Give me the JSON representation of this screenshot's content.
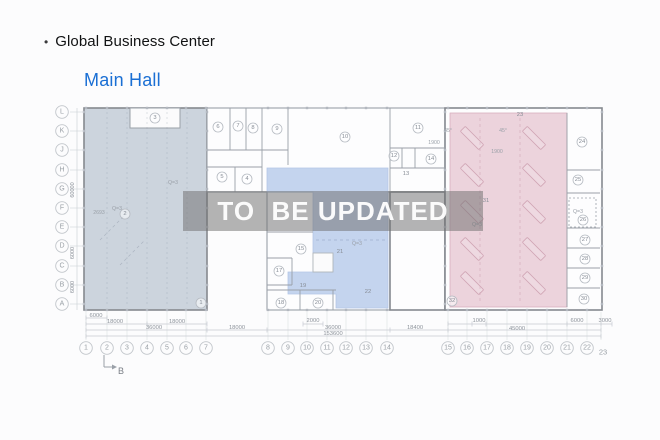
{
  "header": {
    "bullet": "•",
    "title": "Global Business Center",
    "subtitle": "Main Hall"
  },
  "watermark": {
    "text": "TO  BE UPDATED"
  },
  "colors": {
    "page_bg": "#fcfcfd",
    "left_zone": "#ccd4dd",
    "middle_zone": "#c4d4ee",
    "right_zone": "#ecd3dc",
    "subtitle_link": "#1a6fd4",
    "title_text": "#111213",
    "watermark_bg": "rgba(112,112,112,0.52)",
    "watermark_text": "rgba(255,255,255,0.95)",
    "wall": "#9aa0a8",
    "wall_dark": "#85898f",
    "line_light": "#c9cdd3",
    "label": "#8d939b",
    "beam": "#d0a4b4"
  },
  "axes": {
    "rows": [
      {
        "label": "L",
        "y": 112
      },
      {
        "label": "K",
        "y": 131
      },
      {
        "label": "J",
        "y": 150
      },
      {
        "label": "H",
        "y": 170
      },
      {
        "label": "G",
        "y": 189
      },
      {
        "label": "F",
        "y": 208
      },
      {
        "label": "E",
        "y": 227
      },
      {
        "label": "D",
        "y": 246
      },
      {
        "label": "C",
        "y": 266
      },
      {
        "label": "B",
        "y": 285
      },
      {
        "label": "A",
        "y": 304
      }
    ],
    "cols": [
      {
        "label": "1",
        "x": 86
      },
      {
        "label": "2",
        "x": 107
      },
      {
        "label": "3",
        "x": 127
      },
      {
        "label": "4",
        "x": 147
      },
      {
        "label": "5",
        "x": 167
      },
      {
        "label": "6",
        "x": 186
      },
      {
        "label": "7",
        "x": 206
      },
      {
        "label": "8",
        "x": 268
      },
      {
        "label": "9",
        "x": 288
      },
      {
        "label": "10",
        "x": 307
      },
      {
        "label": "11",
        "x": 327
      },
      {
        "label": "12",
        "x": 346
      },
      {
        "label": "13",
        "x": 366
      },
      {
        "label": "14",
        "x": 387
      },
      {
        "label": "15",
        "x": 448
      },
      {
        "label": "16",
        "x": 467
      },
      {
        "label": "17",
        "x": 487
      },
      {
        "label": "18",
        "x": 507
      },
      {
        "label": "19",
        "x": 527
      },
      {
        "label": "20",
        "x": 547
      },
      {
        "label": "21",
        "x": 567
      },
      {
        "label": "22",
        "x": 587
      },
      {
        "label": "23",
        "x": 601,
        "plain": true
      }
    ]
  },
  "rooms": [
    {
      "n": "1",
      "x": 201,
      "y": 303,
      "circled": true
    },
    {
      "n": "2",
      "x": 125,
      "y": 214,
      "circled": true
    },
    {
      "n": "3",
      "x": 155,
      "y": 118,
      "circled": true
    },
    {
      "n": "4",
      "x": 247,
      "y": 179,
      "circled": true
    },
    {
      "n": "5",
      "x": 222,
      "y": 177,
      "circled": true
    },
    {
      "n": "6",
      "x": 218,
      "y": 127,
      "circled": true
    },
    {
      "n": "7",
      "x": 238,
      "y": 126,
      "circled": true
    },
    {
      "n": "8",
      "x": 253,
      "y": 128,
      "circled": true
    },
    {
      "n": "9",
      "x": 277,
      "y": 129,
      "circled": true
    },
    {
      "n": "10",
      "x": 345,
      "y": 137,
      "circled": true
    },
    {
      "n": "11",
      "x": 418,
      "y": 128,
      "circled": true
    },
    {
      "n": "12",
      "x": 394,
      "y": 156,
      "circled": true
    },
    {
      "n": "13",
      "x": 406,
      "y": 174,
      "circled": false
    },
    {
      "n": "14",
      "x": 431,
      "y": 159,
      "circled": true
    },
    {
      "n": "15",
      "x": 301,
      "y": 249,
      "circled": true
    },
    {
      "n": "17",
      "x": 279,
      "y": 271,
      "circled": true
    },
    {
      "n": "18",
      "x": 281,
      "y": 303,
      "circled": true
    },
    {
      "n": "19",
      "x": 303,
      "y": 286,
      "circled": false
    },
    {
      "n": "20",
      "x": 318,
      "y": 303,
      "circled": true
    },
    {
      "n": "21",
      "x": 340,
      "y": 252,
      "circled": false
    },
    {
      "n": "22",
      "x": 368,
      "y": 292,
      "circled": false
    },
    {
      "n": "23",
      "x": 520,
      "y": 115,
      "circled": false
    },
    {
      "n": "24",
      "x": 582,
      "y": 142,
      "circled": true
    },
    {
      "n": "25",
      "x": 578,
      "y": 180,
      "circled": true
    },
    {
      "n": "26",
      "x": 583,
      "y": 220,
      "circled": true
    },
    {
      "n": "27",
      "x": 585,
      "y": 240,
      "circled": true
    },
    {
      "n": "28",
      "x": 585,
      "y": 259,
      "circled": true
    },
    {
      "n": "29",
      "x": 585,
      "y": 278,
      "circled": true
    },
    {
      "n": "30",
      "x": 584,
      "y": 299,
      "circled": true
    },
    {
      "n": "31",
      "x": 486,
      "y": 201,
      "circled": false
    },
    {
      "n": "32",
      "x": 452,
      "y": 301,
      "circled": true
    }
  ],
  "annotations": [
    {
      "t": "Q=3",
      "x": 173,
      "y": 183
    },
    {
      "t": "Q=3",
      "x": 117,
      "y": 209
    },
    {
      "t": "2693",
      "x": 99,
      "y": 213
    },
    {
      "t": "Q=3",
      "x": 357,
      "y": 244
    },
    {
      "t": "Q=3",
      "x": 477,
      "y": 225
    },
    {
      "t": "Q=3",
      "x": 578,
      "y": 212
    },
    {
      "t": "1900",
      "x": 434,
      "y": 143
    },
    {
      "t": "1900",
      "x": 497,
      "y": 152
    },
    {
      "t": "45°",
      "x": 448,
      "y": 131
    },
    {
      "t": "45°",
      "x": 503,
      "y": 131
    }
  ],
  "dimensions": [
    {
      "t": "6000",
      "x": 96,
      "y": 316
    },
    {
      "t": "18000",
      "x": 115,
      "y": 322
    },
    {
      "t": "18000",
      "x": 177,
      "y": 322
    },
    {
      "t": "2000",
      "x": 313,
      "y": 321
    },
    {
      "t": "36000",
      "x": 154,
      "y": 328
    },
    {
      "t": "18000",
      "x": 237,
      "y": 328
    },
    {
      "t": "36000",
      "x": 333,
      "y": 328
    },
    {
      "t": "18400",
      "x": 415,
      "y": 328
    },
    {
      "t": "45000",
      "x": 517,
      "y": 329
    },
    {
      "t": "153600",
      "x": 333,
      "y": 334
    },
    {
      "t": "1000",
      "x": 479,
      "y": 321
    },
    {
      "t": "6000",
      "x": 577,
      "y": 321
    },
    {
      "t": "3000",
      "x": 605,
      "y": 321
    }
  ],
  "v_dimensions": [
    {
      "t": "60000",
      "x": 73,
      "y": 190
    },
    {
      "t": "6000",
      "x": 73,
      "y": 253
    },
    {
      "t": "6000",
      "x": 73,
      "y": 287
    }
  ],
  "section_marker": {
    "label": "B"
  }
}
